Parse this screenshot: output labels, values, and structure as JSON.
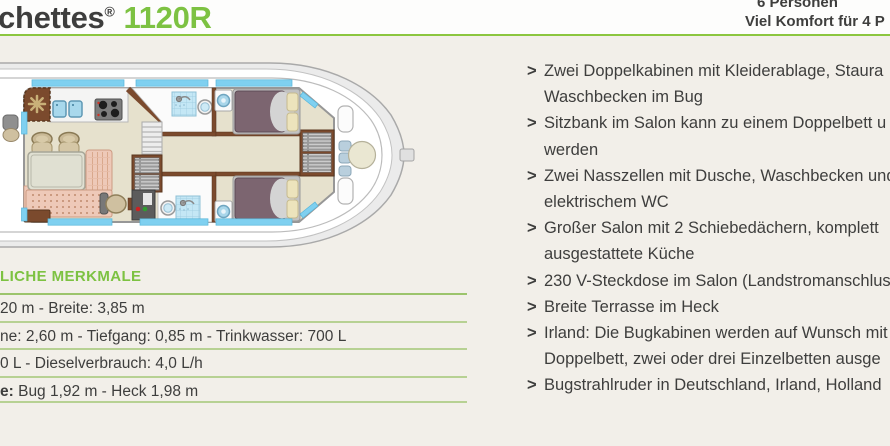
{
  "header": {
    "title_prefix": "chettes",
    "title_reg": "®",
    "title_model": "1120R",
    "capacity_line1": "6 Personen",
    "capacity_line2": "Viel Komfort für 4 P"
  },
  "specs": {
    "heading": "LICHE MERKMALE",
    "rows": [
      {
        "bold": "",
        "text": "20 m - Breite: 3,85 m"
      },
      {
        "bold": "",
        "text": "ne: 2,60 m -  Tiefgang: 0,85 m - Trinkwasser: 700 L"
      },
      {
        "bold": "",
        "text": "0 L - Dieselverbrauch: 4,0 L/h"
      },
      {
        "bold": "e:",
        "text": " Bug 1,92 m - Heck 1,98 m"
      }
    ]
  },
  "features": {
    "bullet": ">",
    "items": [
      {
        "lines": [
          "Zwei Doppelkabinen mit Kleiderablage, Staura",
          "Waschbecken im Bug"
        ]
      },
      {
        "lines": [
          "Sitzbank im Salon kann zu einem Doppelbett u",
          "werden"
        ]
      },
      {
        "lines": [
          "Zwei Nasszellen mit Dusche, Waschbecken und",
          "elektrischem WC"
        ]
      },
      {
        "lines": [
          "Großer Salon mit 2 Schiebedächern, komplett",
          "ausgestattete Küche"
        ]
      },
      {
        "lines": [
          "230 V-Steckdose im Salon (Landstromanschluss"
        ]
      },
      {
        "lines": [
          "Breite Terrasse im Heck"
        ]
      },
      {
        "lines": [
          "Irland: Die Bugkabinen werden auf Wunsch mit",
          "Doppelbett, zwei oder drei Einzelbetten ausge"
        ]
      },
      {
        "lines": [
          "Bugstrahlruder in Deutschland, Irland, Holland"
        ]
      }
    ]
  },
  "colors": {
    "page_bg": "#f2efe9",
    "header_bg": "#fdfdfc",
    "accent_green": "#7dc242",
    "rule_green": "#8cc63f",
    "divider_green": "#b7d193",
    "divider_strong": "#9cc46c",
    "text_dark": "#3e3e3d",
    "hull_gray": "#ebebeb",
    "wood_brown": "#7b4a2d",
    "floor_beige": "#e6e1cd",
    "window_blue": "#7fd0f0",
    "tile_blue": "#c4e7f5",
    "bed_mauve": "#7c6570",
    "pillow_cream": "#ece3bc",
    "sofa_pink": "#eec9b8",
    "table_gray": "#e0e0d2",
    "chair_tan": "#cfc0a0"
  }
}
